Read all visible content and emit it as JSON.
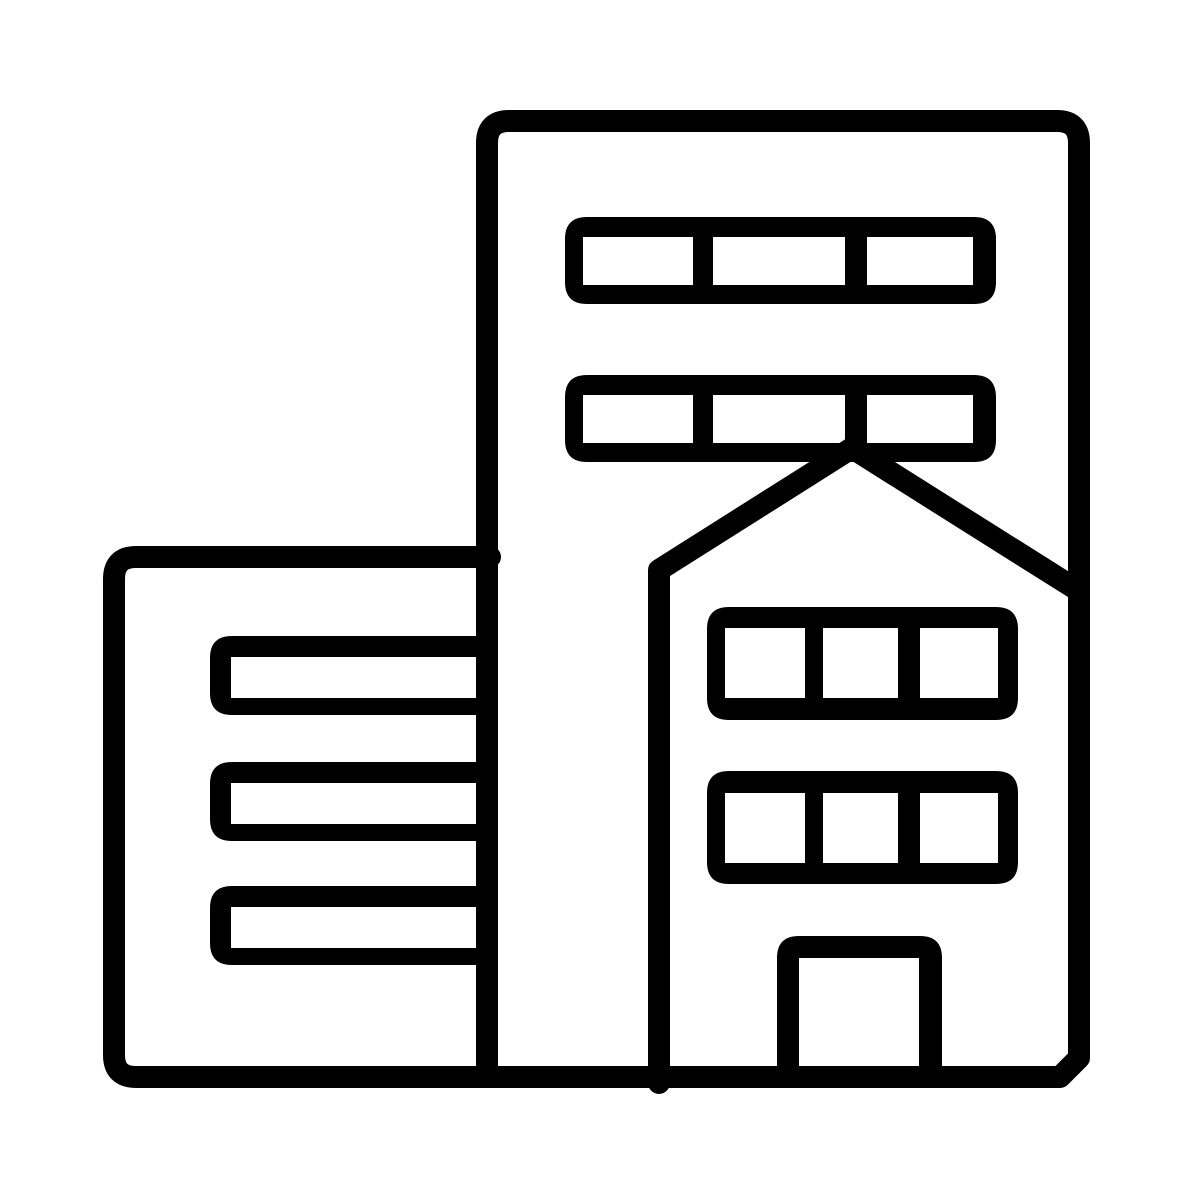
{
  "page": {
    "background_color": "#ffffff",
    "description": "Black monochrome line-art pictogram of city buildings: a tall office tower with two window strips, an attached low annex building with three window bars, and a gable-roofed house facade with two window strips and a central door."
  },
  "icon": {
    "semantic_name": "city-buildings-icon",
    "ink_color": "#000000",
    "hole_color": "#ffffff",
    "stroke_width": 22,
    "canvas": {
      "width": 1200,
      "height": 1198
    },
    "elements": [
      {
        "type": "stroke",
        "part": "annex-building-outline",
        "d": "M 490 557 L 136 557 Q 114 557 114 579 L 114 1055 Q 114 1077 136 1077 L 490 1077"
      },
      {
        "type": "fill",
        "part": "annex-window-bar-1",
        "d": "M 232 636 L 495 636 L 495 715 L 232 715 Q 210 715 210 693 L 210 658 Q 210 636 232 636 Z"
      },
      {
        "type": "fill",
        "part": "annex-window-bar-2",
        "d": "M 232 762 L 495 762 L 495 841 L 232 841 Q 210 841 210 819 L 210 784 Q 210 762 232 762 Z"
      },
      {
        "type": "fill",
        "part": "annex-window-bar-3",
        "d": "M 232 886 L 495 886 L 495 965 L 232 965 Q 210 965 210 943 L 210 908 Q 210 886 232 886 Z"
      },
      {
        "type": "hole",
        "part": "annex-window-pane-1",
        "d": "M 231 657 H 477 V 698 H 231 Z"
      },
      {
        "type": "hole",
        "part": "annex-window-pane-2",
        "d": "M 231 783 H 477 V 824 H 231 Z"
      },
      {
        "type": "hole",
        "part": "annex-window-pane-3",
        "d": "M 231 907 H 477 V 948 H 231 Z"
      },
      {
        "type": "stroke",
        "part": "tower-building-outline",
        "d": "M 487 1077 L 487 143 Q 487 121 509 121 L 1057 121 Q 1079 121 1079 143 L 1079 1058 L 1060 1077 L 487 1077"
      },
      {
        "type": "fill",
        "part": "tower-window-strip-1",
        "d": "M 587 217 L 974 217 Q 996 217 996 239 L 996 282 Q 996 304 974 304 L 587 304 Q 565 304 565 282 L 565 239 Q 565 217 587 217 Z"
      },
      {
        "type": "hole",
        "part": "tower-strip1-pane-1",
        "d": "M 583 237 H 693 V 285 H 583 Z"
      },
      {
        "type": "hole",
        "part": "tower-strip1-pane-2",
        "d": "M 713 237 H 845 V 285 H 713 Z"
      },
      {
        "type": "hole",
        "part": "tower-strip1-pane-3",
        "d": "M 867 237 H 973 V 285 H 867 Z"
      },
      {
        "type": "fill",
        "part": "tower-window-strip-2",
        "d": "M 587 375 L 974 375 Q 996 375 996 397 L 996 440 Q 996 462 974 462 L 587 462 Q 565 462 565 440 L 565 397 Q 565 375 587 375 Z"
      },
      {
        "type": "hole",
        "part": "tower-strip2-pane-1",
        "d": "M 583 395 H 693 V 443 H 583 Z"
      },
      {
        "type": "hole",
        "part": "tower-strip2-pane-2",
        "d": "M 713 395 H 845 V 443 H 713 Z"
      },
      {
        "type": "hole",
        "part": "tower-strip2-pane-3",
        "d": "M 867 395 H 973 V 443 H 867 Z"
      },
      {
        "type": "stroke",
        "part": "house-gable-and-wall",
        "d": "M 659 1083 L 659 570 L 852 448 L 1079 591"
      },
      {
        "type": "fill",
        "part": "house-window-strip-1",
        "d": "M 729 607 L 996 607 Q 1018 607 1018 629 L 1018 698 Q 1018 720 996 720 L 729 720 Q 707 720 707 698 L 707 629 Q 707 607 729 607 Z"
      },
      {
        "type": "hole",
        "part": "house-strip1-pane-1",
        "d": "M 725 628 H 805 V 698 H 725 Z"
      },
      {
        "type": "hole",
        "part": "house-strip1-pane-2",
        "d": "M 823 628 H 898 V 698 H 823 Z"
      },
      {
        "type": "hole",
        "part": "house-strip1-pane-3",
        "d": "M 920 628 H 998 V 698 H 920 Z"
      },
      {
        "type": "fill",
        "part": "house-window-strip-2",
        "d": "M 729 771 L 996 771 Q 1018 771 1018 793 L 1018 862 Q 1018 884 996 884 L 729 884 Q 707 884 707 862 L 707 793 Q 707 771 729 771 Z"
      },
      {
        "type": "hole",
        "part": "house-strip2-pane-1",
        "d": "M 725 793 H 805 V 863 H 725 Z"
      },
      {
        "type": "hole",
        "part": "house-strip2-pane-2",
        "d": "M 823 793 H 898 V 863 H 823 Z"
      },
      {
        "type": "hole",
        "part": "house-strip2-pane-3",
        "d": "M 920 793 H 998 V 863 H 920 Z"
      },
      {
        "type": "fill",
        "part": "house-door",
        "d": "M 777 1088 L 777 958 Q 777 936 799 936 L 920 936 Q 942 936 942 958 L 942 1088 Z"
      },
      {
        "type": "hole",
        "part": "house-door-pane",
        "d": "M 799 958 H 919 V 1066 H 799 Z"
      }
    ]
  }
}
